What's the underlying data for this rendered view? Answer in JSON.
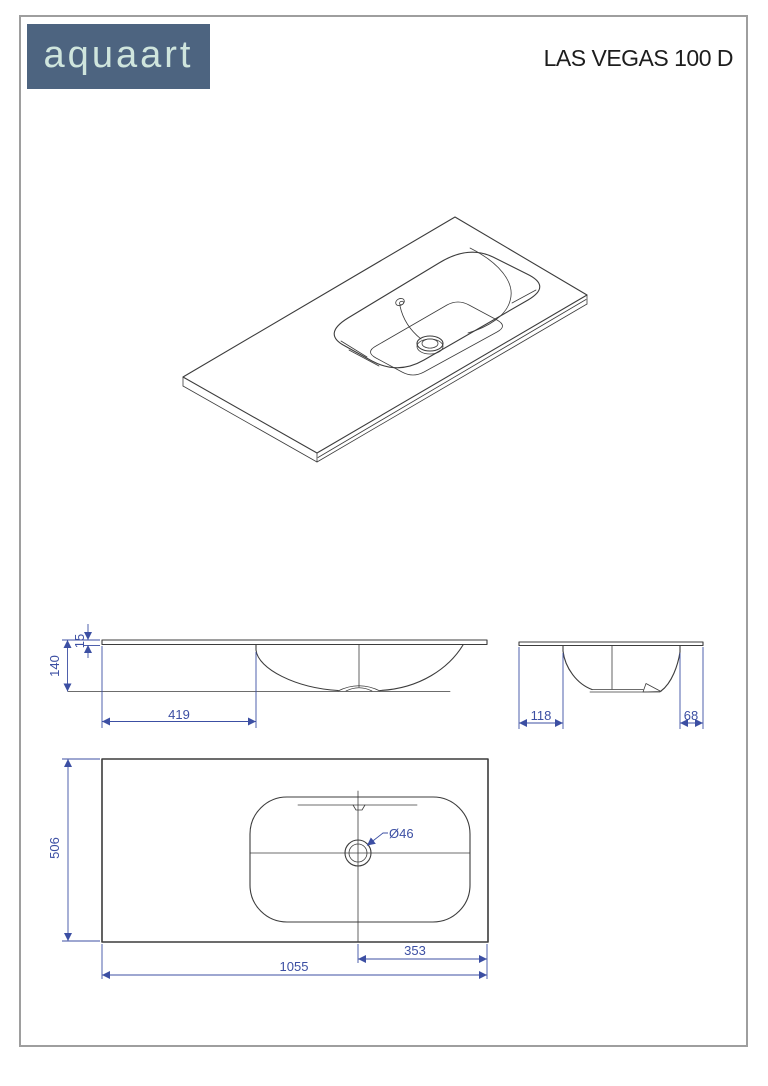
{
  "header": {
    "logo_text": "aquaart",
    "product_title": "LAS VEGAS 100 D"
  },
  "dimensions": {
    "front": {
      "total_height": "140",
      "top_thickness": "15",
      "basin_offset_left": "419"
    },
    "side": {
      "edge_to_basin_left": "118",
      "basin_to_edge_right": "68"
    },
    "plan": {
      "depth": "506",
      "drain_diameter": "Ø46",
      "drain_to_right_edge": "353",
      "total_width": "1055"
    }
  },
  "colors": {
    "dimension_blue": "#3c4fa3",
    "drawing_line": "#3c3c3c",
    "logo_background": "#4d6480",
    "logo_text_color": "#cfe5dd",
    "page_border": "#9e9e9e",
    "title_color": "#1d1d1d"
  }
}
